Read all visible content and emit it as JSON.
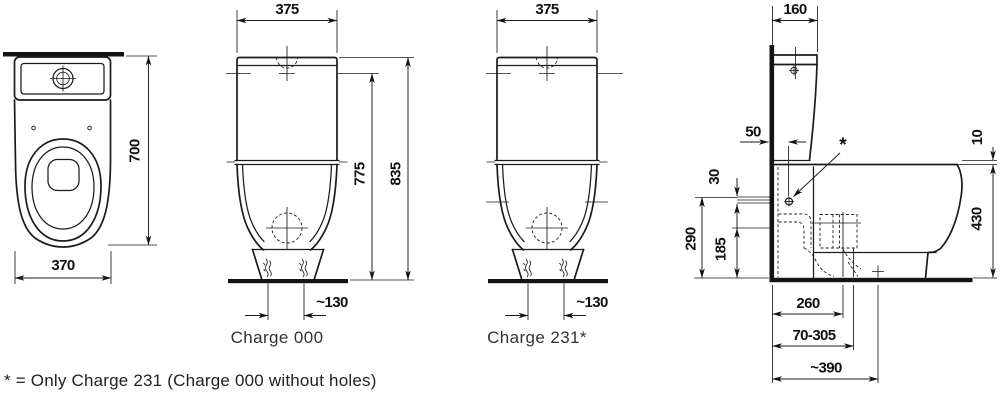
{
  "footnote": "* = Only Charge 231 (Charge 000 without holes)",
  "top_view": {
    "width": "370",
    "depth": "700"
  },
  "front_000": {
    "width": "375",
    "height_inner": "775",
    "height_total": "835",
    "bolt_spacing": "~130",
    "caption": "Charge 000"
  },
  "front_231": {
    "width": "375",
    "bolt_spacing": "~130",
    "caption": "Charge 231*"
  },
  "side_view": {
    "cistern_depth": "160",
    "inlet_offset": "50",
    "supply_span": "30",
    "supply_height": "290",
    "outlet_height": "185",
    "rim_step": "10",
    "rim_height": "430",
    "outlet_dist": "260",
    "outlet_range": "70-305",
    "outlet_max": "~390",
    "asterisk": "*"
  }
}
